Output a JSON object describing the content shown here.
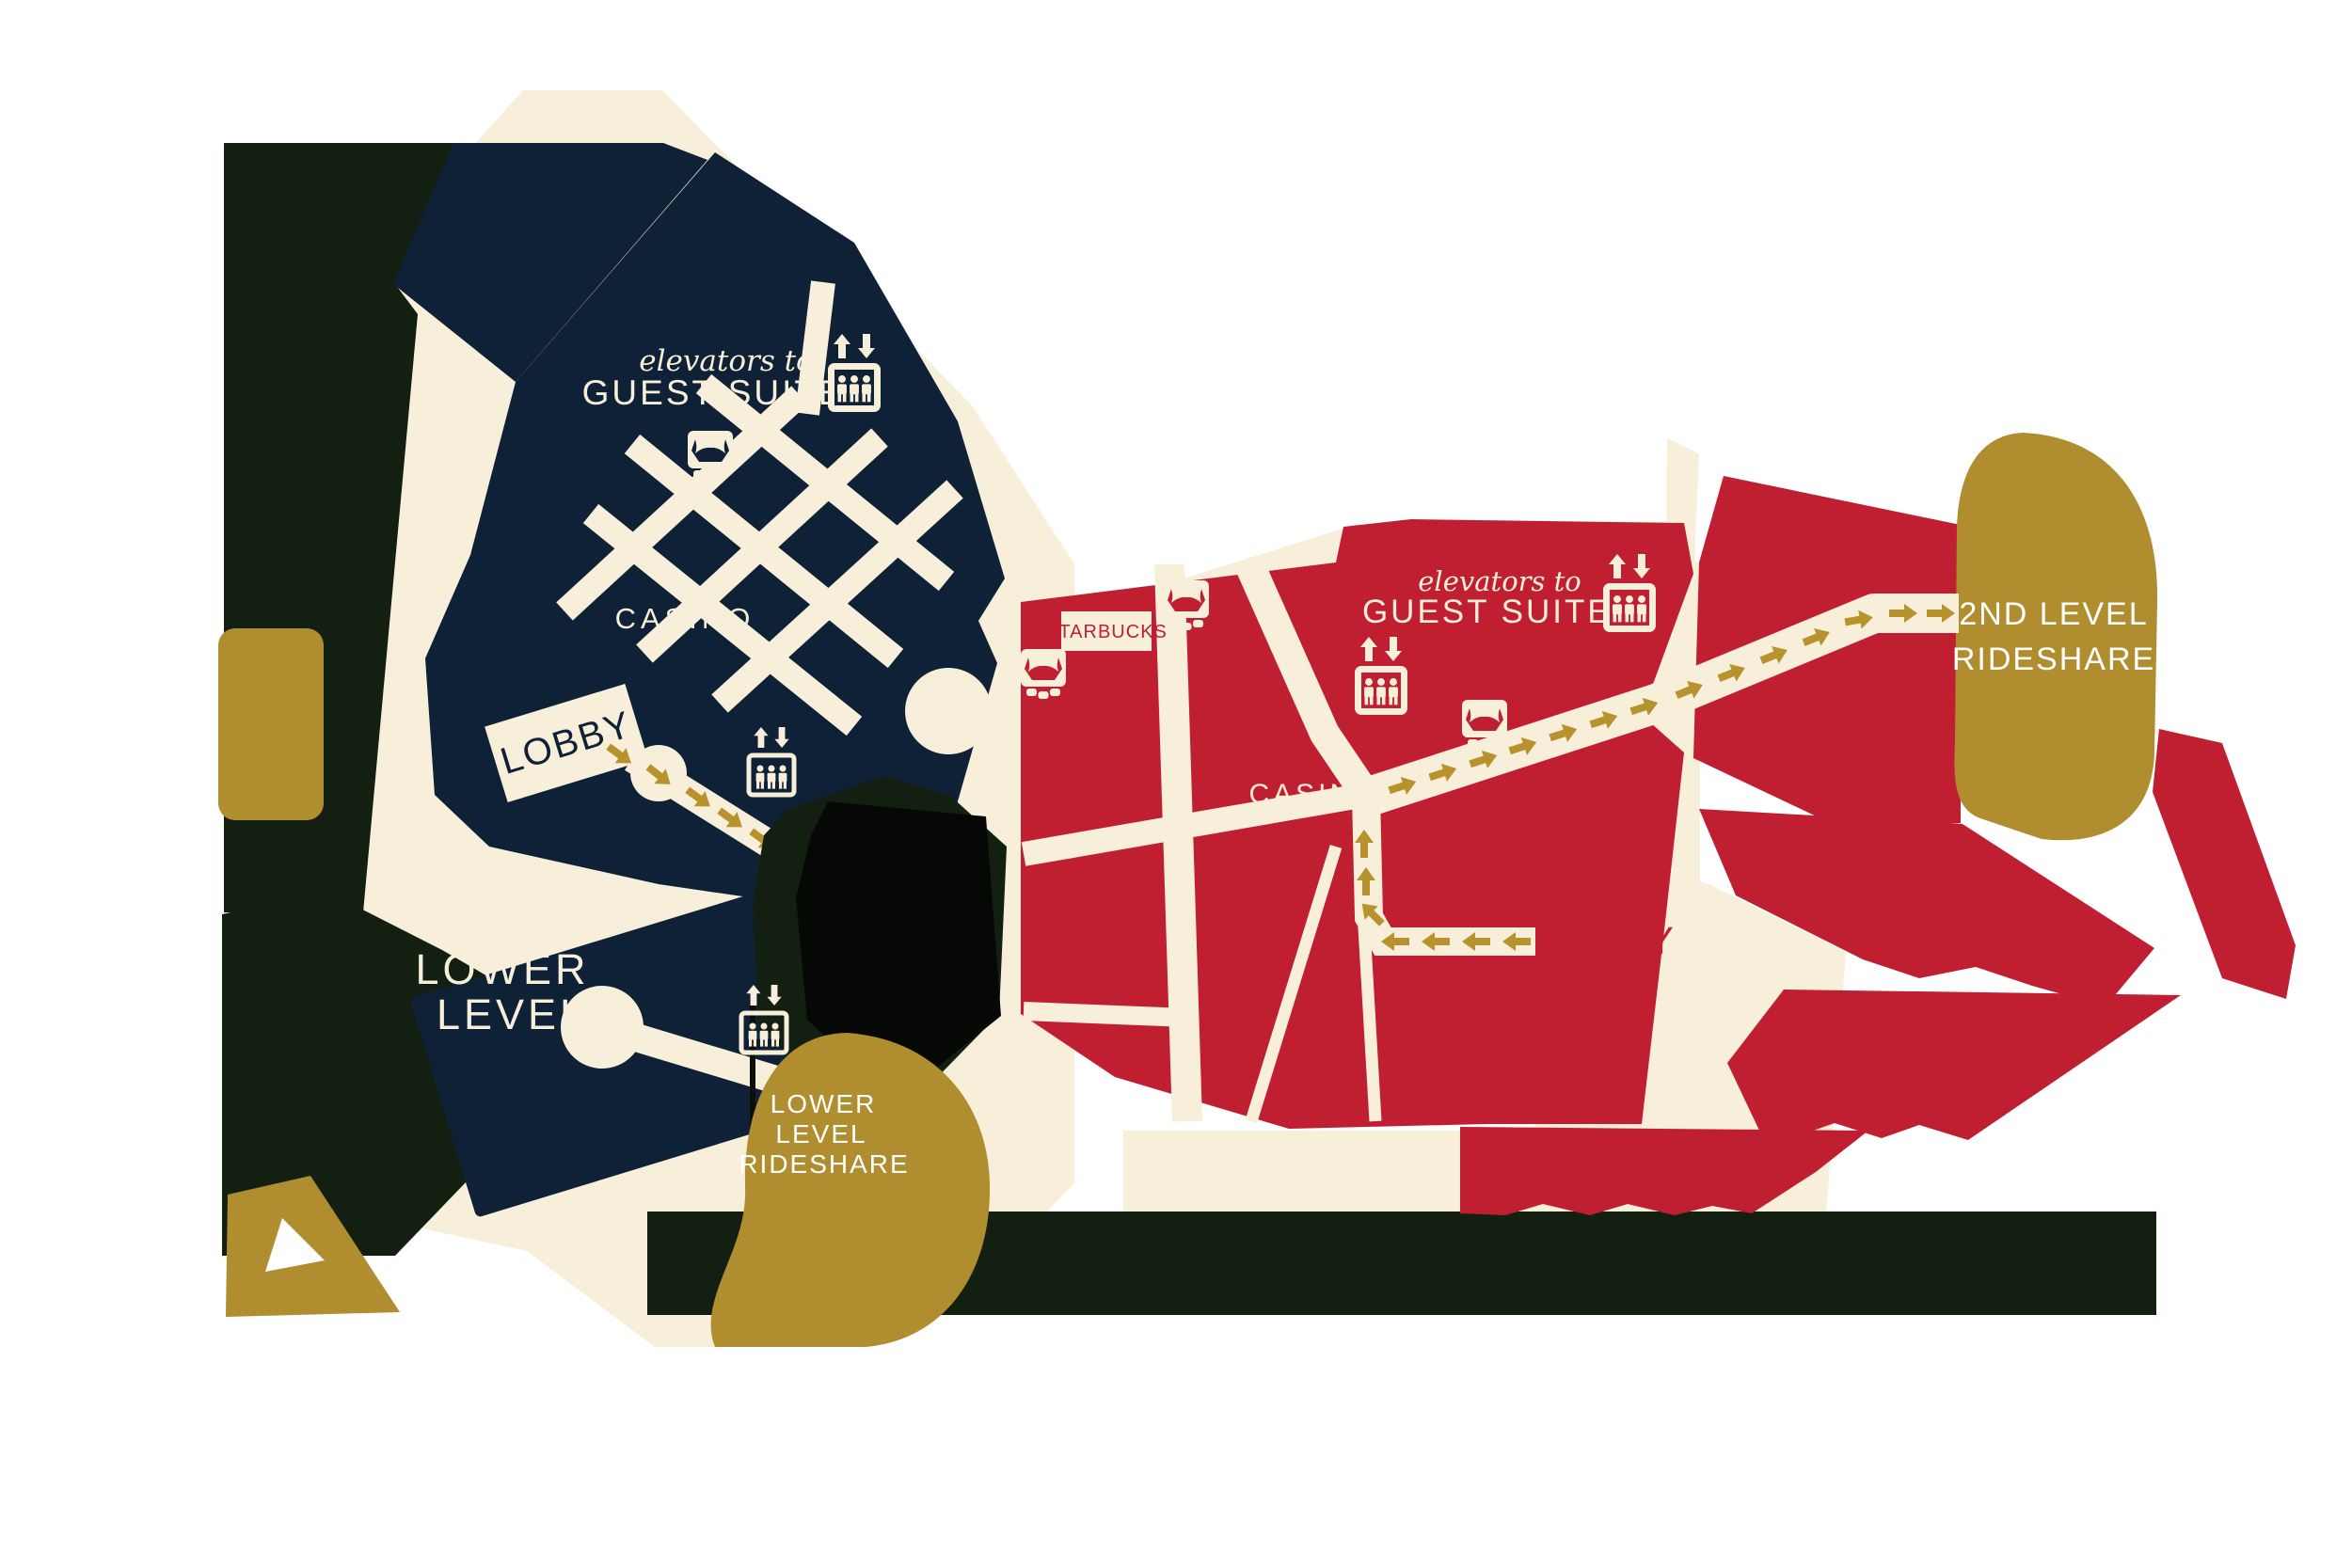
{
  "map": {
    "navy_tower": {
      "elevators_line1": "elevators to",
      "elevators_line2": "GUEST SUITES",
      "casino": "CASINO",
      "lobby": "LOBBY",
      "lower_line1": "LOWER",
      "lower_line2": "LEVEL"
    },
    "red_tower": {
      "elevators_line1": "elevators to",
      "elevators_line2": "GUEST SUITES",
      "casino": "CASINO",
      "lobby": "LOBBY",
      "starbucks": "STARBUCKS"
    },
    "rideshare_2nd": {
      "line1": "2ND LEVEL",
      "line2": "RIDESHARE"
    },
    "rideshare_lower": {
      "line1": "LOWER",
      "line2": "LEVEL",
      "line3": "RIDESHARE"
    }
  },
  "icons": [
    "elevator-filled-icon",
    "elevator-outline-icon",
    "theater-icon",
    "up-arrow-icon",
    "down-arrow-icon",
    "direction-arrow-icon"
  ],
  "colors": {
    "navy": "#0f2137",
    "red": "#c01f31",
    "cream": "#f7efda",
    "gold": "#b08d2f",
    "arrow_gold": "#b8922d",
    "dark_green": "#131f10",
    "black": "#060806",
    "white": "#ffffff"
  }
}
